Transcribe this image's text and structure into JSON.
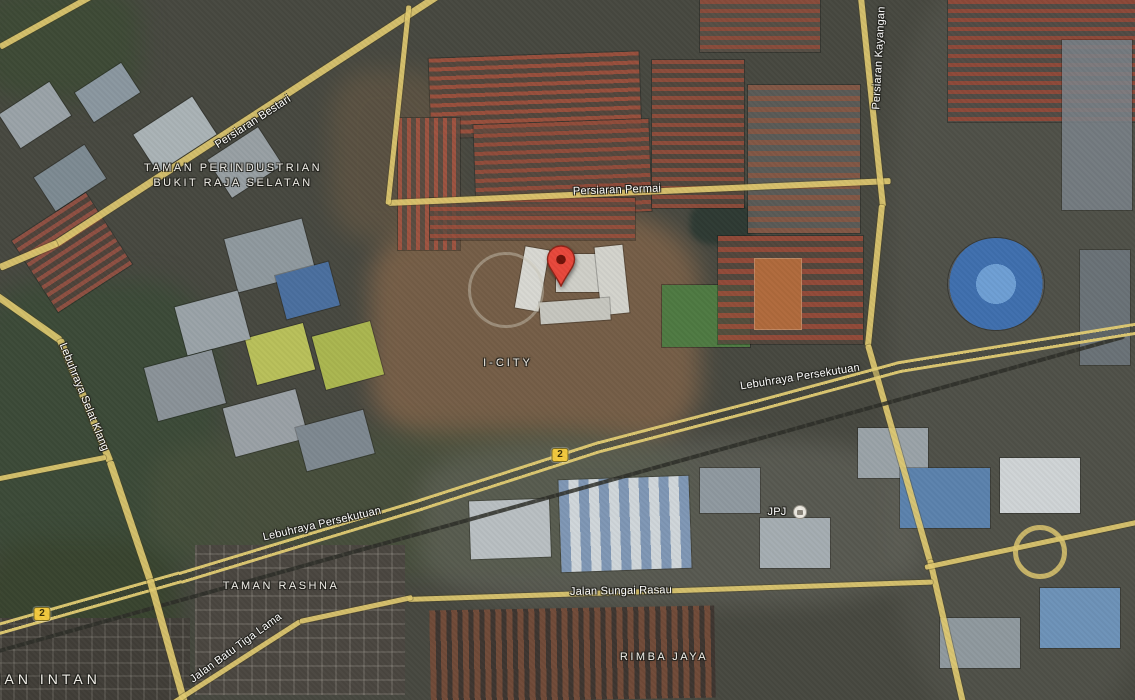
{
  "map": {
    "view_type": "satellite",
    "road_labels": {
      "persiaran_bestari": "Persiaran Bestari",
      "persiaran_kayangan": "Persiaran Kayangan",
      "persiaran_permai": "Persiaran Permai",
      "lebuhraya_persekutuan_right": "Lebuhraya Persekutuan",
      "lebuhraya_persekutuan_left": "Lebuhraya Persekutuan",
      "lebuhraya_selat_klang": "Lebuhraya Selat Klang",
      "jalan_sungai_rasau": "Jalan Sungai Rasau",
      "jalan_batu_tiga_lama": "Jalan Batu Tiga Lama"
    },
    "area_labels": {
      "taman_perindustrian_line1": "TAMAN PERINDUSTRIAN",
      "taman_perindustrian_line2": "BUKIT RAJA SELATAN",
      "i_city": "I-CITY",
      "taman_rashna": "TAMAN RASHNA",
      "rimba_jaya": "RIMBA JAYA",
      "taman_intan": "TAMAN INTAN"
    },
    "poi_labels": {
      "jpj": "JPJ"
    },
    "route_shields": {
      "federal_route_highway": "2",
      "federal_route_west": "2"
    },
    "colors": {
      "road_yellow": "#dfc96f",
      "shield_yellow": "#f3c93e",
      "marker_red": "#e8473b",
      "label_white": "#ffffff"
    }
  }
}
